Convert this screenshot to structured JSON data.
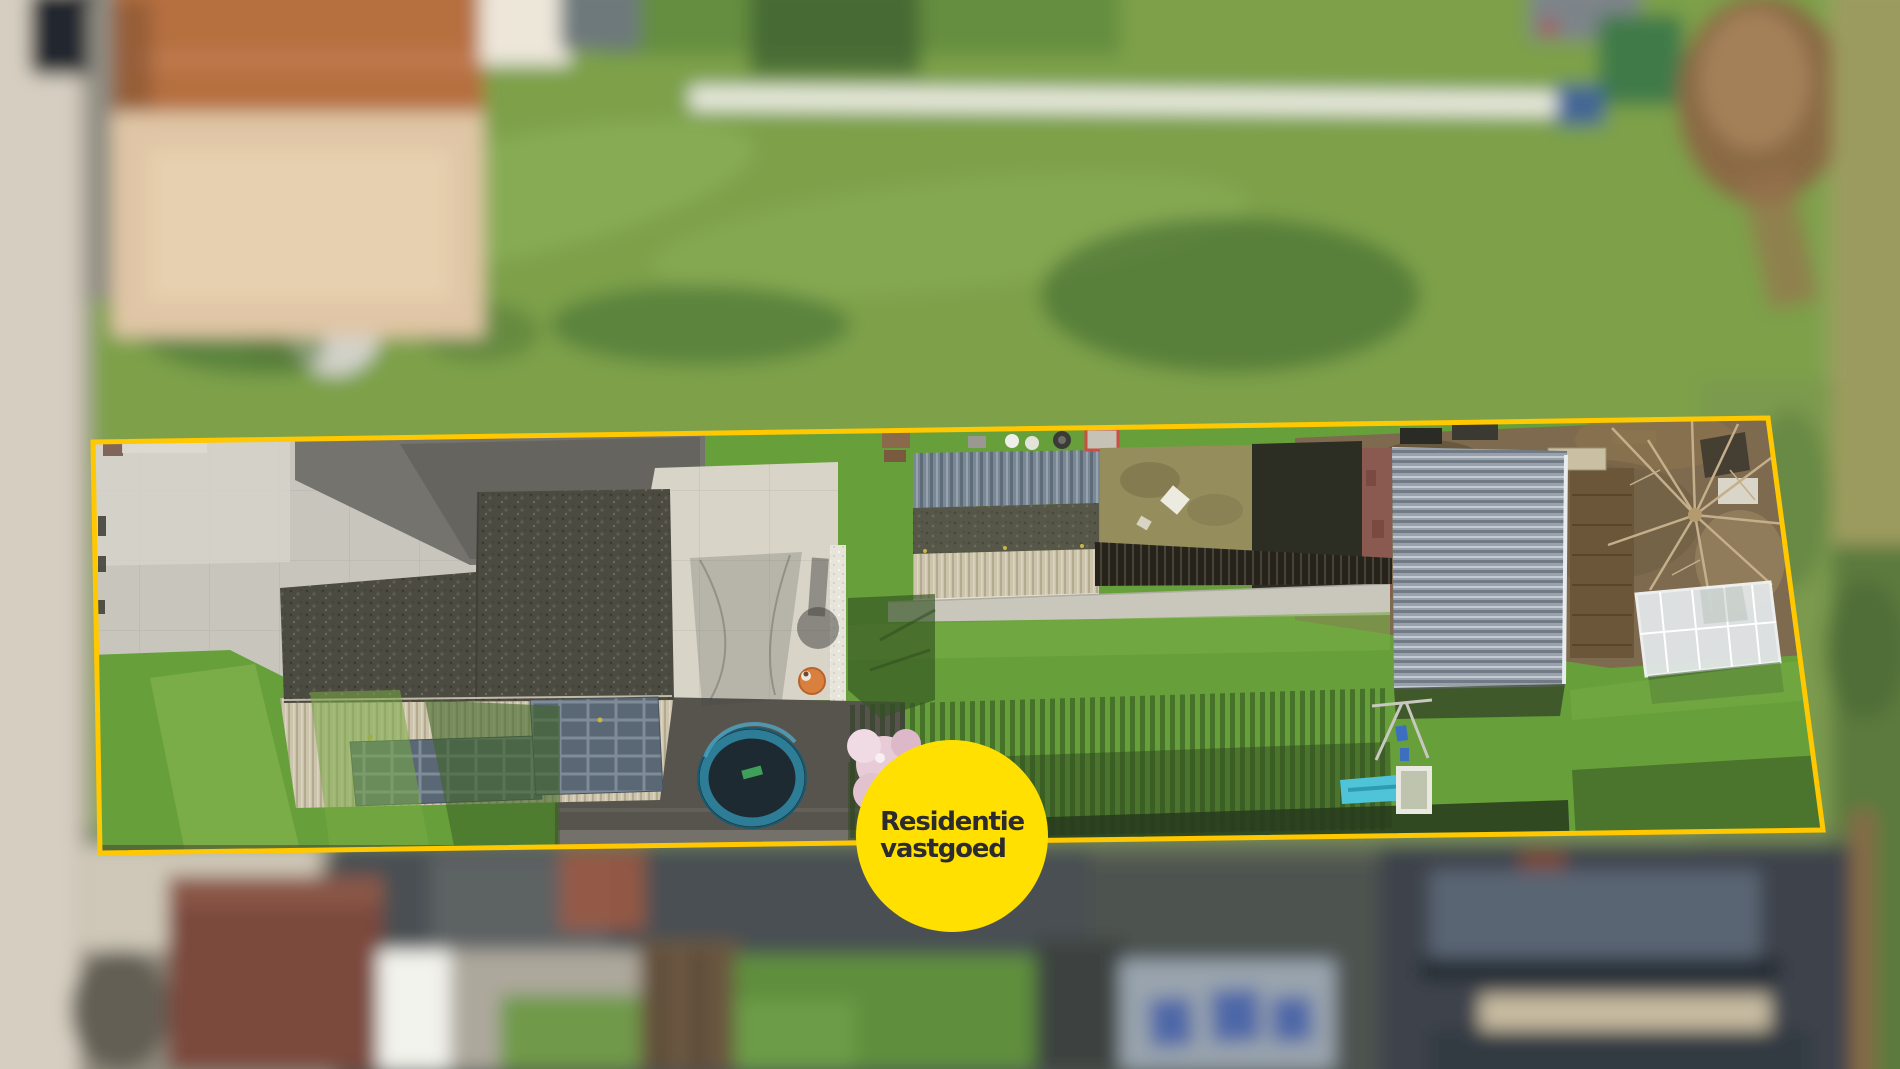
{
  "badge": {
    "line1": "Residentie",
    "line2": "vastgoed",
    "background": "#FFE000",
    "text_color": "#2B2B30"
  },
  "boundary": {
    "color": "#FFC800",
    "points": "93,442 1768,418 1823,830 100,853",
    "stroke_width": "5"
  },
  "scene": {
    "colors": {
      "meadow": "#7DA04A",
      "lawn": "#67A03A",
      "road": "#D6CFC1",
      "driveway": "#C8C5BD",
      "asphalt": "#6B6965",
      "patio": "#D8D4C8",
      "paving_dark": "#57544E",
      "garden_soil": "#7D6A4F",
      "dead_grass": "#958D5C",
      "greenhouse": "#E2E7E8",
      "brick_wall": "#8A5A50",
      "orange_table": "#D9803F",
      "trampoline_mat": "#1E2A31",
      "trampoline_rim": "#2E7D96",
      "blossom_tree": "#E7CBD6",
      "slide_blue": "#4FC3D8",
      "roof_orange": "#B66F41",
      "roof_brown": "#7B4A3C",
      "building_gray": "#9AA4AE",
      "window_blue": "#4E68A8"
    }
  }
}
